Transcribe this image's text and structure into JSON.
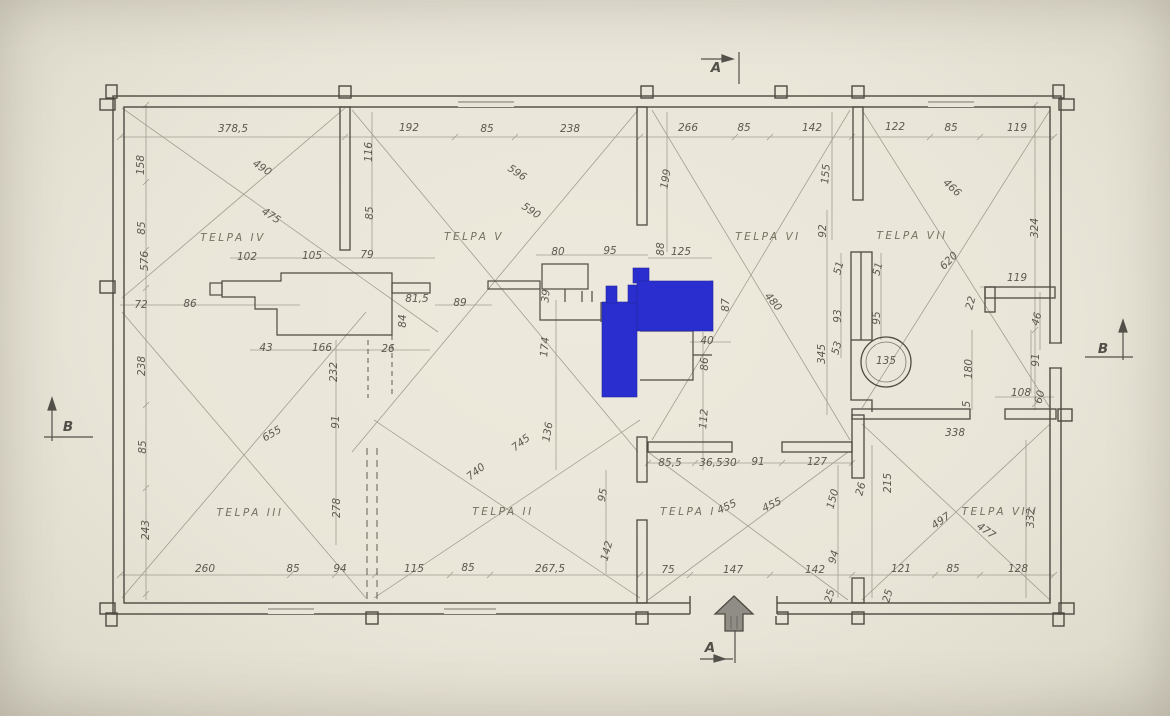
{
  "drawing": {
    "type": "hand-drawn architectural floor plan",
    "rooms": [
      "TELPA I",
      "TELPA II",
      "TELPA III",
      "TELPA IV",
      "TELPA V",
      "TELPA VI",
      "TELPA VII",
      "TELPA VIII"
    ],
    "section_markers": [
      "A",
      "B"
    ],
    "highlighted_feature": "blue filled wall/stove region in plan center"
  },
  "colors": {
    "paper": "#e9e5d8",
    "wall_ink": "#4e4a42",
    "pencil": "#8b8678",
    "text": "#5d5950",
    "highlight_blue": "#2b2ecf",
    "arrow_gray": "#8f8d85"
  },
  "plan": {
    "room_labels": [
      {
        "t": "TELPA IV",
        "x": 233,
        "y": 238
      },
      {
        "t": "TELPA V",
        "x": 474,
        "y": 237
      },
      {
        "t": "TELPA VI",
        "x": 768,
        "y": 237
      },
      {
        "t": "TELPA VII",
        "x": 912,
        "y": 236
      },
      {
        "t": "TELPA III",
        "x": 250,
        "y": 513
      },
      {
        "t": "TELPA II",
        "x": 503,
        "y": 512
      },
      {
        "t": "TELPA I",
        "x": 688,
        "y": 512
      },
      {
        "t": "TELPA VIII",
        "x": 1000,
        "y": 512
      }
    ],
    "section_labels": [
      {
        "t": "A",
        "x": 716,
        "y": 68
      },
      {
        "t": "A",
        "x": 710,
        "y": 648
      },
      {
        "t": "B",
        "x": 68,
        "y": 427
      },
      {
        "t": "B",
        "x": 1103,
        "y": 349
      }
    ],
    "dimension_labels": [
      {
        "t": "378,5",
        "x": 233,
        "y": 129
      },
      {
        "t": "192",
        "x": 409,
        "y": 128
      },
      {
        "t": "85",
        "x": 487,
        "y": 129
      },
      {
        "t": "238",
        "x": 570,
        "y": 129
      },
      {
        "t": "266",
        "x": 688,
        "y": 128
      },
      {
        "t": "85",
        "x": 744,
        "y": 128
      },
      {
        "t": "142",
        "x": 812,
        "y": 128
      },
      {
        "t": "122",
        "x": 895,
        "y": 127
      },
      {
        "t": "85",
        "x": 951,
        "y": 128
      },
      {
        "t": "119",
        "x": 1017,
        "y": 128
      },
      {
        "t": "158",
        "x": 141,
        "y": 165,
        "r": -90
      },
      {
        "t": "85",
        "x": 142,
        "y": 228,
        "r": -90
      },
      {
        "t": "576",
        "x": 145,
        "y": 261,
        "r": -90
      },
      {
        "t": "72",
        "x": 141,
        "y": 305
      },
      {
        "t": "86",
        "x": 190,
        "y": 304
      },
      {
        "t": "238",
        "x": 142,
        "y": 366,
        "r": -90
      },
      {
        "t": "85",
        "x": 143,
        "y": 447,
        "r": -90
      },
      {
        "t": "243",
        "x": 146,
        "y": 530,
        "r": -90
      },
      {
        "t": "490",
        "x": 262,
        "y": 168,
        "r": 33
      },
      {
        "t": "475",
        "x": 271,
        "y": 216,
        "r": 33
      },
      {
        "t": "116",
        "x": 369,
        "y": 152,
        "r": -90
      },
      {
        "t": "85",
        "x": 370,
        "y": 213,
        "r": -90
      },
      {
        "t": "102",
        "x": 247,
        "y": 257
      },
      {
        "t": "105",
        "x": 312,
        "y": 256
      },
      {
        "t": "79",
        "x": 367,
        "y": 255
      },
      {
        "t": "81,5",
        "x": 417,
        "y": 299
      },
      {
        "t": "89",
        "x": 460,
        "y": 303
      },
      {
        "t": "84",
        "x": 403,
        "y": 321,
        "r": -90
      },
      {
        "t": "43",
        "x": 266,
        "y": 348
      },
      {
        "t": "166",
        "x": 322,
        "y": 348
      },
      {
        "t": "26",
        "x": 388,
        "y": 349
      },
      {
        "t": "232",
        "x": 334,
        "y": 372,
        "r": -90
      },
      {
        "t": "91",
        "x": 336,
        "y": 422,
        "r": -90
      },
      {
        "t": "278",
        "x": 337,
        "y": 508,
        "r": -90
      },
      {
        "t": "596",
        "x": 517,
        "y": 173,
        "r": 33
      },
      {
        "t": "590",
        "x": 531,
        "y": 211,
        "r": 33
      },
      {
        "t": "80",
        "x": 558,
        "y": 252
      },
      {
        "t": "95",
        "x": 610,
        "y": 251
      },
      {
        "t": "88",
        "x": 661,
        "y": 249,
        "r": -90
      },
      {
        "t": "125",
        "x": 681,
        "y": 252
      },
      {
        "t": "39",
        "x": 546,
        "y": 296,
        "r": -85
      },
      {
        "t": "174",
        "x": 545,
        "y": 347,
        "r": -85
      },
      {
        "t": "136",
        "x": 548,
        "y": 432,
        "r": -80
      },
      {
        "t": "95",
        "x": 603,
        "y": 495,
        "r": -80
      },
      {
        "t": "142",
        "x": 607,
        "y": 551,
        "r": -75
      },
      {
        "t": "87",
        "x": 726,
        "y": 305,
        "r": -90
      },
      {
        "t": "40",
        "x": 707,
        "y": 341
      },
      {
        "t": "86",
        "x": 705,
        "y": 364,
        "r": -90
      },
      {
        "t": "112",
        "x": 704,
        "y": 419,
        "r": -85
      },
      {
        "t": "199",
        "x": 666,
        "y": 179,
        "r": -80
      },
      {
        "t": "155",
        "x": 826,
        "y": 174,
        "r": -85
      },
      {
        "t": "92",
        "x": 823,
        "y": 231,
        "r": -90
      },
      {
        "t": "480",
        "x": 773,
        "y": 302,
        "r": 50
      },
      {
        "t": "345",
        "x": 822,
        "y": 354,
        "r": -90
      },
      {
        "t": "51",
        "x": 839,
        "y": 268,
        "r": -75
      },
      {
        "t": "51",
        "x": 878,
        "y": 269,
        "r": -75
      },
      {
        "t": "93",
        "x": 838,
        "y": 316,
        "r": -90
      },
      {
        "t": "95",
        "x": 877,
        "y": 318,
        "r": -90
      },
      {
        "t": "53",
        "x": 837,
        "y": 348,
        "r": -75
      },
      {
        "t": "135",
        "x": 886,
        "y": 361
      },
      {
        "t": "620",
        "x": 949,
        "y": 261,
        "r": -45
      },
      {
        "t": "466",
        "x": 952,
        "y": 188,
        "r": 42
      },
      {
        "t": "324",
        "x": 1035,
        "y": 228,
        "r": -90
      },
      {
        "t": "119",
        "x": 1017,
        "y": 278
      },
      {
        "t": "22",
        "x": 971,
        "y": 303,
        "r": -75
      },
      {
        "t": "46",
        "x": 1037,
        "y": 319,
        "r": -75
      },
      {
        "t": "180",
        "x": 969,
        "y": 369,
        "r": -90
      },
      {
        "t": "91",
        "x": 1036,
        "y": 360,
        "r": -90
      },
      {
        "t": "108",
        "x": 1021,
        "y": 393
      },
      {
        "t": "60",
        "x": 1040,
        "y": 397,
        "r": -75
      },
      {
        "t": "5",
        "x": 967,
        "y": 404,
        "r": -90
      },
      {
        "t": "85,5",
        "x": 670,
        "y": 463
      },
      {
        "t": "36,5",
        "x": 711,
        "y": 463
      },
      {
        "t": "30",
        "x": 730,
        "y": 463
      },
      {
        "t": "91",
        "x": 758,
        "y": 462
      },
      {
        "t": "127",
        "x": 817,
        "y": 462
      },
      {
        "t": "455",
        "x": 727,
        "y": 507,
        "r": -25
      },
      {
        "t": "455",
        "x": 772,
        "y": 505,
        "r": -25
      },
      {
        "t": "150",
        "x": 833,
        "y": 499,
        "r": -75
      },
      {
        "t": "94",
        "x": 834,
        "y": 557,
        "r": -75
      },
      {
        "t": "25",
        "x": 830,
        "y": 596,
        "r": -75
      },
      {
        "t": "25",
        "x": 888,
        "y": 596,
        "r": -75
      },
      {
        "t": "338",
        "x": 955,
        "y": 433
      },
      {
        "t": "215",
        "x": 888,
        "y": 483,
        "r": -90
      },
      {
        "t": "497",
        "x": 941,
        "y": 521,
        "r": -35
      },
      {
        "t": "477",
        "x": 986,
        "y": 531,
        "r": 35
      },
      {
        "t": "332",
        "x": 1031,
        "y": 518,
        "r": -90
      },
      {
        "t": "26",
        "x": 861,
        "y": 489,
        "r": -75
      },
      {
        "t": "655",
        "x": 272,
        "y": 434,
        "r": -30
      },
      {
        "t": "740",
        "x": 476,
        "y": 472,
        "r": -38
      },
      {
        "t": "745",
        "x": 521,
        "y": 443,
        "r": -38
      },
      {
        "t": "260",
        "x": 205,
        "y": 569
      },
      {
        "t": "85",
        "x": 293,
        "y": 569
      },
      {
        "t": "94",
        "x": 340,
        "y": 569
      },
      {
        "t": "115",
        "x": 414,
        "y": 569
      },
      {
        "t": "85",
        "x": 468,
        "y": 568
      },
      {
        "t": "267,5",
        "x": 550,
        "y": 569
      },
      {
        "t": "75",
        "x": 668,
        "y": 570
      },
      {
        "t": "147",
        "x": 733,
        "y": 570
      },
      {
        "t": "142",
        "x": 815,
        "y": 570
      },
      {
        "t": "121",
        "x": 901,
        "y": 569
      },
      {
        "t": "85",
        "x": 953,
        "y": 569
      },
      {
        "t": "128",
        "x": 1018,
        "y": 569
      }
    ]
  }
}
